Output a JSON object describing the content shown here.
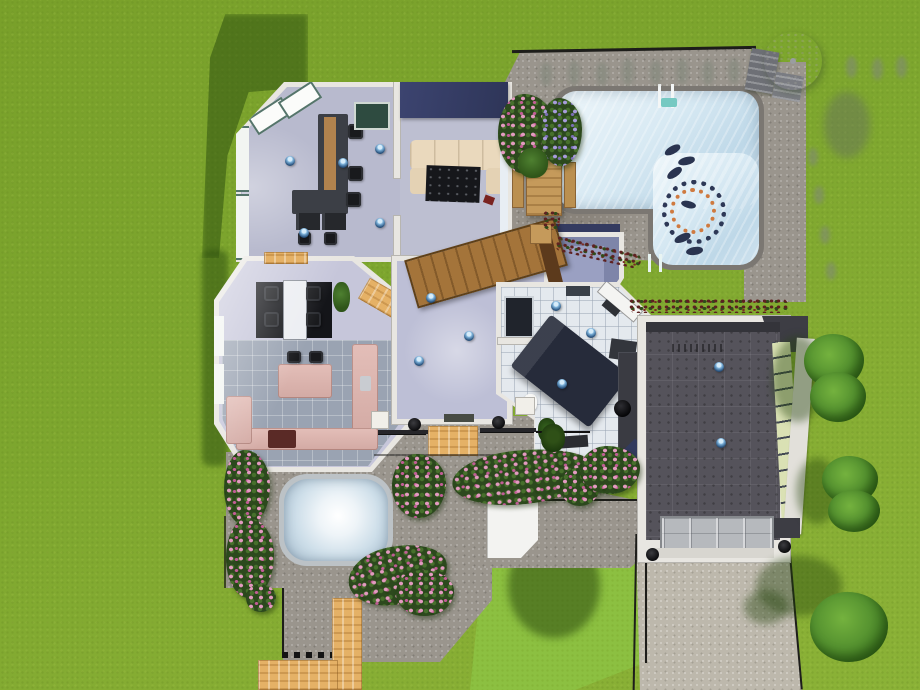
{
  "app": {
    "name": "life-simulation-game",
    "view": "top-down-lot-overview",
    "subject": "suburban-house-with-pool"
  },
  "palette": {
    "grass": "#7da62e",
    "grass_bright": "#8cc041",
    "cast_shadow": "#2a4c0d",
    "stone_path": "#9a958d",
    "driveway": "#bdb8ac",
    "pool_water": "#d7e9f3",
    "pond_water": "#eef4f8",
    "wall": "#e8e6e1",
    "roof_navy": "#343b60",
    "floor_lavender": "#b8bace",
    "floor_kitchen_tile": "#9aa3b2",
    "floor_bathroom": "#e4e9ee",
    "floor_garage": "#55535b",
    "floor_closet": "#7e85a9",
    "counter_pink": "#d9b3ad",
    "stair_wood": "#a4743a",
    "desk_dark": "#3c3f46",
    "desk_wood_top": "#b2834e",
    "sofa_cream": "#ead9bd",
    "rug_black": "#141519",
    "bed_navy": "#262b3a",
    "door_teal": "#2e4b40",
    "mat_tan": "#e5b166",
    "flower_pink": "#e39ac0",
    "flower_purple": "#a79bdb",
    "foliage": "#3c7520",
    "garage_glass": "#dae1b4",
    "umbrella": "#f5f5f2",
    "mosaic_navy": "#2e3856",
    "mosaic_orange": "#cf7a40"
  },
  "objects": {
    "pool": "swimming-pool",
    "pool_ladder": "pool-ladder",
    "pool_mosaic": "dolphin-mosaic",
    "pond": "plunge-pool",
    "umbrella": "patio-umbrella",
    "lounge": "lounge-chair",
    "picnic_table": "picnic-table",
    "stairs": "wooden-staircase",
    "bed": "double-bed",
    "sofa": "sectional-sofa",
    "media": "home-theater-rug",
    "desk": "office-desk",
    "dining_table": "dining-table",
    "kitchen": "kitchen-counter",
    "island": "kitchen-island",
    "stove": "stove",
    "shower": "shower-stall",
    "toilet": "toilet",
    "sink": "bathroom-sink",
    "garage": "garage",
    "garage_door": "garage-door",
    "driveway": "driveway",
    "doormat": "doormat",
    "fence": "porch-fence",
    "lamp": "outdoor-lamp",
    "floor_lamp": "blue-floor-lamp",
    "tree": "tree",
    "bush": "flower-bush",
    "groundcover": "red-groundcover",
    "tuft": "ornamental-grass",
    "closet": "closet-room",
    "office": "home-office",
    "living": "living-room",
    "dining": "dining-room",
    "bathroom": "bathroom",
    "bedroom": "bedroom",
    "hall": "hallway",
    "porch": "entry-porch",
    "lawn": "lawn-patch",
    "tile_patch": "white-tile-patch",
    "walkway": "wood-walkway"
  },
  "counts": {
    "flower_bushes": 12,
    "trees": 3,
    "blue_floor_lamps": 13,
    "rooms": 8
  }
}
